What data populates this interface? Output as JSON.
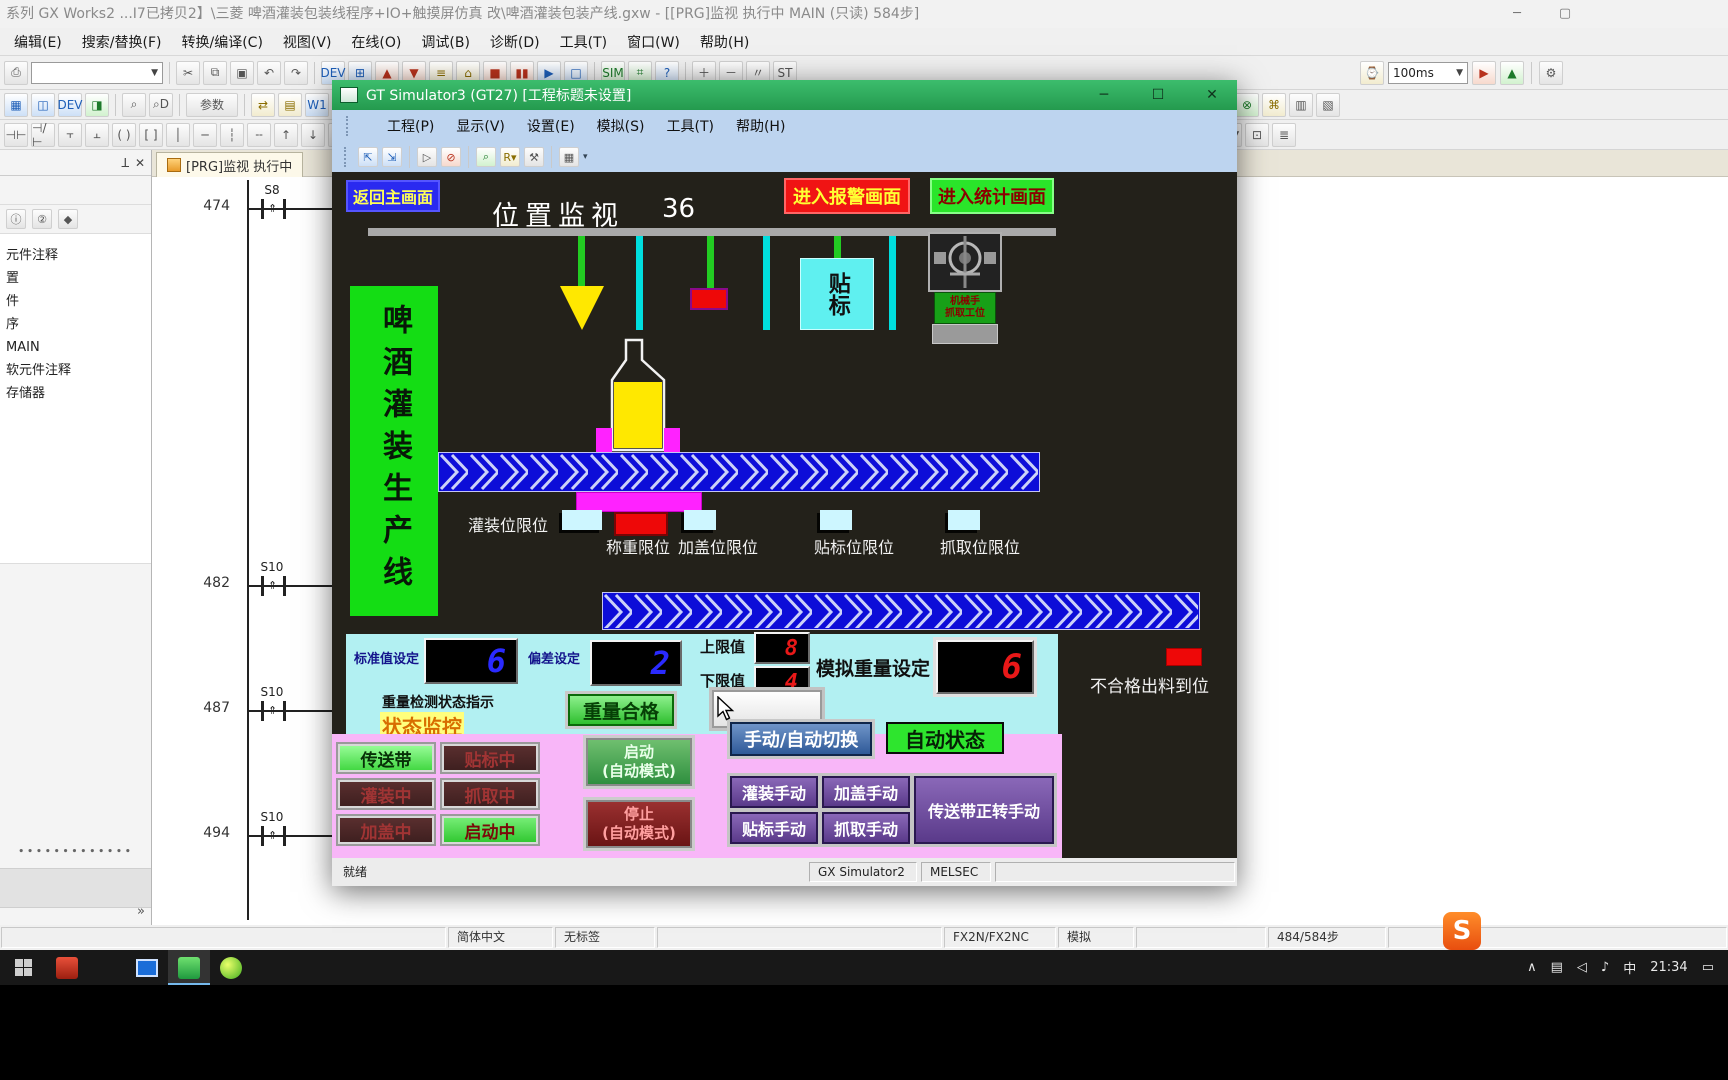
{
  "gx_works2": {
    "titlebar": {
      "title": "系列 GX Works2 ...I7已拷贝2】\\三菱  啤酒灌装包装线程序+IO+触摸屏仿真 改\\啤酒灌装包装产线.gxw - [[PRG]监视 执行中 MAIN (只读) 584步]"
    },
    "menu_items": [
      "编辑(E)",
      "搜索/替换(F)",
      "转换/编译(C)",
      "视图(V)",
      "在线(O)",
      "调试(B)",
      "诊断(D)",
      "工具(T)",
      "窗口(W)",
      "帮助(H)"
    ],
    "toolbar": {
      "scan_combo": "100ms",
      "param_button": "参数"
    },
    "project_tree": {
      "items": [
        "元件注释",
        "置",
        "件",
        "序",
        "MAIN",
        "软元件注释",
        "存储器"
      ]
    },
    "ladder": {
      "tab_label": "[PRG]监视 执行中",
      "rungs": [
        {
          "step": "474",
          "contact": "S8"
        },
        {
          "step": "482",
          "contact": "S10"
        },
        {
          "step": "487",
          "contact": "S10"
        },
        {
          "step": "494",
          "contact": "S10"
        }
      ]
    },
    "statusbar": {
      "language": "简体中文",
      "label": "无标签",
      "cpu": "FX2N/FX2NC",
      "mode": "模拟",
      "steps": "484/584步"
    }
  },
  "gt_simulator": {
    "titlebar": {
      "title": "GT Simulator3 (GT27)  [工程标题未设置]"
    },
    "menu_items": [
      "工程(P)",
      "显示(V)",
      "设置(E)",
      "模拟(S)",
      "工具(T)",
      "帮助(H)"
    ],
    "hmi": {
      "back_button": "返回主画面",
      "screen_title": "位置监视",
      "screen_number": "36",
      "alarm_button": "进入报警画面",
      "stats_button": "进入统计画面",
      "banner": "啤酒灌装生产线",
      "labeling_station": "贴标",
      "robot_station_line1": "机械手",
      "robot_station_line2": "抓取工位",
      "sensors": [
        "灌装位限位",
        "称重限位",
        "加盖位限位",
        "贴标位限位",
        "抓取位限位"
      ],
      "settings": {
        "standard_label": "标准值设定",
        "standard_value": "6",
        "deviation_label": "偏差设定",
        "deviation_value": "2",
        "upper_label": "上限值",
        "upper_value": "8",
        "lower_label": "下限值",
        "lower_value": "4",
        "sim_weight_label": "模拟重量设定",
        "sim_weight_value": "6"
      },
      "weight_status_label": "重量检测状态指示",
      "weight_ok_button": "重量合格",
      "status_monitor_label": "状态监控",
      "reject_label": "不合格出料到位",
      "indicators": [
        "传送带",
        "贴标中",
        "灌装中",
        "抓取中",
        "加盖中",
        "启动中"
      ],
      "start_button_line1": "启动",
      "start_button_line2": "(自动模式)",
      "stop_button_line1": "停止",
      "stop_button_line2": "(自动模式)",
      "mode_switch_button": "手动/自动切换",
      "auto_status": "自动状态",
      "manual_buttons": [
        "灌装手动",
        "加盖手动",
        "贴标手动",
        "抓取手动",
        "传送带正转手动"
      ]
    },
    "statusbar": {
      "ready": "就绪",
      "simulator": "GX Simulator2",
      "device": "MELSEC"
    }
  },
  "taskbar": {
    "clock": "21:34",
    "ime": "中"
  }
}
